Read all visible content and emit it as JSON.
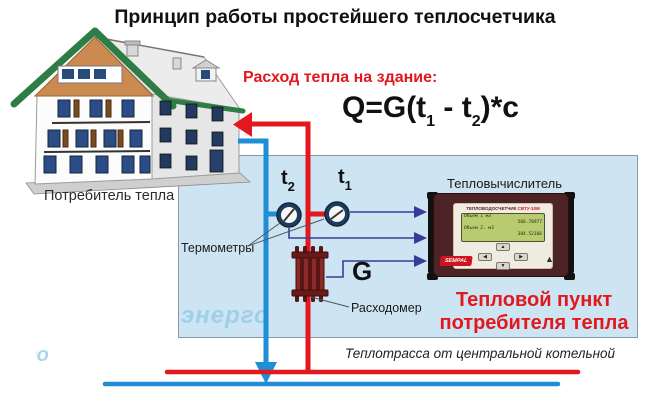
{
  "title": "Принцип работы простейшего теплосчетчика",
  "house": {
    "label": "Потребитель тепла"
  },
  "consumption": {
    "heading": "Расход тепла на здание:"
  },
  "formula": {
    "p1": "Q=G(t",
    "s1": "1",
    "p2": " - t",
    "s2": "2",
    "p3": ")*c"
  },
  "sensors": {
    "t2_main": "t",
    "t2_sub": "2",
    "t1_main": "t",
    "t1_sub": "1",
    "thermometers_label": "Термометры",
    "flow_symbol": "G",
    "flowmeter_label": "Расходомер"
  },
  "calculator": {
    "label": "Тепловычислитель",
    "header_left": "ТЕПЛОВОДОСЧЕТЧИК",
    "header_right": "СВТУ-10М",
    "lcd_lines": [
      "Объем 1   м3",
      "566.78977",
      "Объем 2.  м3",
      "384.52166"
    ],
    "btn_up": "▲",
    "btn_left": "◀",
    "btn_right": "▶",
    "btn_down": "▼",
    "brand": "SEMPAL",
    "emblem": "▲"
  },
  "heat_point": {
    "line1": "Тепловой пункт",
    "line2": "потребителя тепла"
  },
  "pipeline": {
    "label": "Теплотрасса от центральной котельной"
  },
  "watermark": {
    "text": "энерго"
  },
  "colors": {
    "red": "#e2181e",
    "blue": "#1e8ed6",
    "navy_arrow": "#3b3a98",
    "box_fill": "#cde4f2",
    "device_body": "#4e2326",
    "lcd_green": "#b9cb70",
    "roof_green": "#2e7d46",
    "gable_orange": "#cb8a4f"
  }
}
